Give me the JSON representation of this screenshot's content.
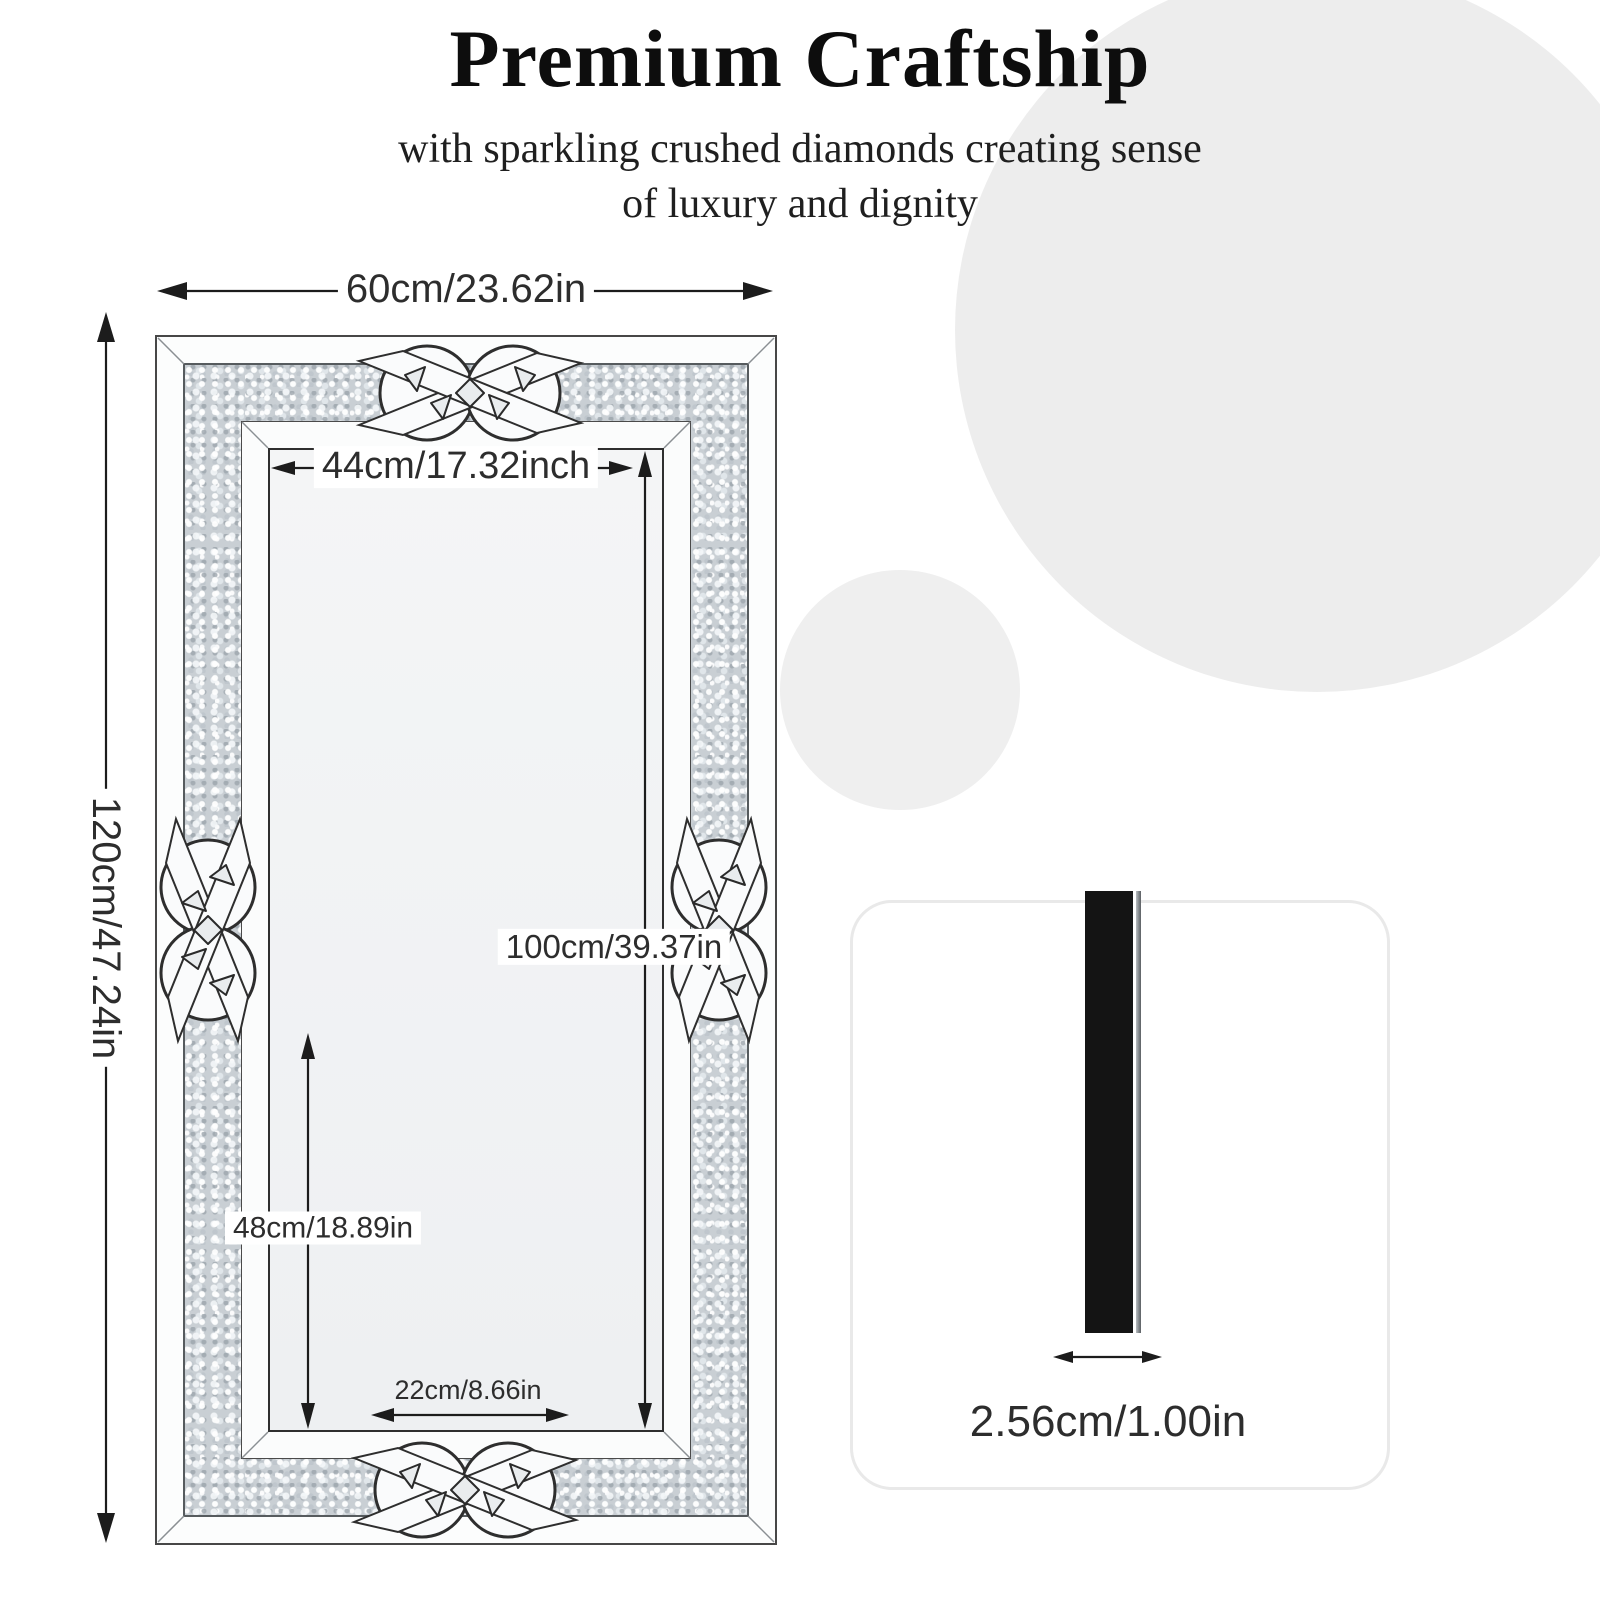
{
  "header": {
    "title": "Premium Craftship",
    "subtitle_line1": "with sparkling crushed diamonds creating sense",
    "subtitle_line2": "of luxury and dignity"
  },
  "mirror_diagram": {
    "dimensions": {
      "outer_width": "60cm/23.62in",
      "outer_height": "120cm/47.24in",
      "inner_width": "44cm/17.32inch",
      "inner_height": "100cm/39.37in",
      "lower_height": "48cm/18.89in",
      "bottom_width": "22cm/8.66in"
    },
    "ornament_icon": "celtic-knot-icon",
    "frame_texture": "crushed-diamond-sparkle"
  },
  "side_view": {
    "thickness": "2.56cm/1.00in"
  },
  "colors": {
    "background": "#ffffff",
    "circle_large": "#ededed",
    "circle_small": "#efefef",
    "sparkle_base": "#c9cfd4",
    "annotation_line": "#1c1c1c",
    "side_bar": "#141414"
  }
}
